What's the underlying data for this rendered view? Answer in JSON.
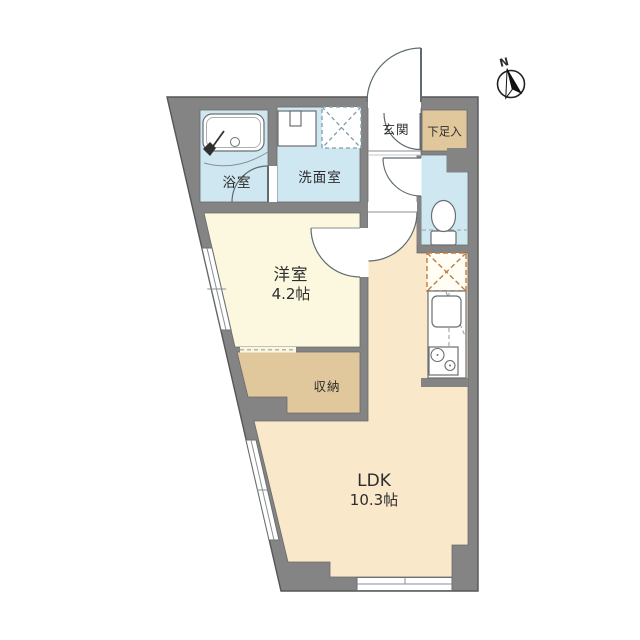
{
  "compass": {
    "north_label": "N"
  },
  "rooms": {
    "bathroom": {
      "label": "浴室"
    },
    "washroom": {
      "label": "洗面室"
    },
    "entrance": {
      "label": "玄関"
    },
    "shoe_storage": {
      "label": "下足入"
    },
    "western_room": {
      "label": "洋室",
      "size": "4.2帖"
    },
    "storage": {
      "label": "収納"
    },
    "ldk": {
      "label": "LDK",
      "size": "10.3帖"
    }
  },
  "colors": {
    "wall": "#848484",
    "wet_area_floor": "#cfe7f0",
    "tan_floor": "#e0c79c",
    "western_room_floor": "#fcf8df",
    "ldk_floor": "#f9e8ca",
    "hall_floor": "#ffffff",
    "fridge_dash": "#bf7d3f",
    "washer_dash": "#7f9dac"
  }
}
